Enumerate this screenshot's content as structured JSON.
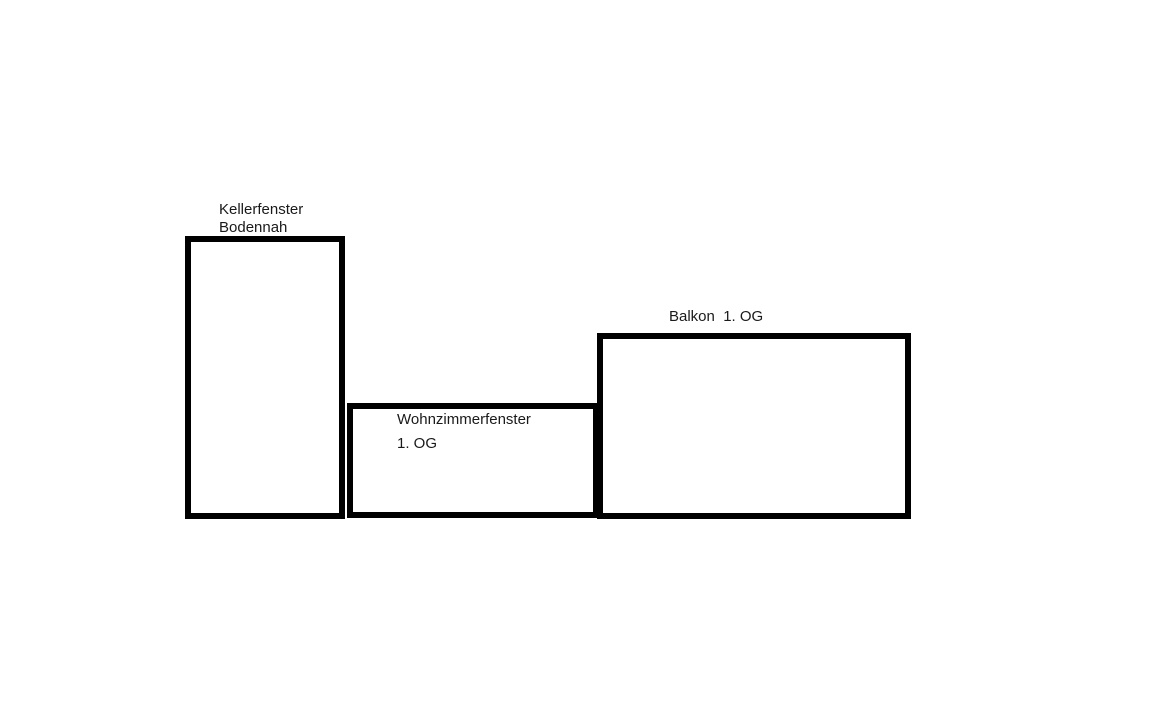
{
  "diagram": {
    "background_color": "#ffffff",
    "stroke_color": "#000000",
    "text_color": "#1a1a1a",
    "boxes": [
      {
        "id": "kellerfenster",
        "label_lines": [
          "Kellerfenster",
          "Bodennah"
        ],
        "label_placement": "above-box"
      },
      {
        "id": "wohnzimmerfenster",
        "label_lines": [
          "Wohnzimmerfenster",
          "1. OG"
        ],
        "label_placement": "inside-top-left"
      },
      {
        "id": "balkon",
        "label_lines": [
          "Balkon  1. OG"
        ],
        "label_placement": "above-box"
      }
    ]
  }
}
